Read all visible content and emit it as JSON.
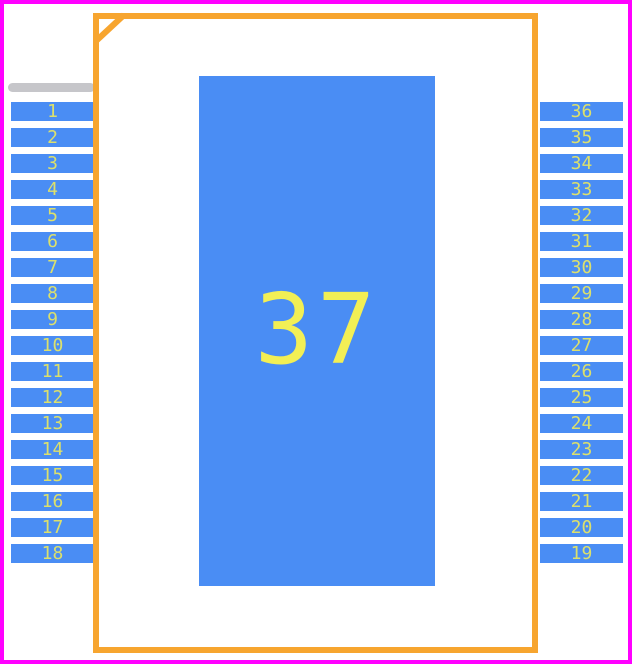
{
  "colors": {
    "background": "#ffffff",
    "pad_blue": "#4a8df4",
    "outline_orange": "#f7a52f",
    "border_magenta": "#ff00ff",
    "marker_gray": "#c6c6ca",
    "pin_number_yellow": "#dce06c",
    "pad_number_yellow": "#f2ef55"
  },
  "footprint": {
    "center_pad": {
      "number": "37"
    },
    "left_pins": {
      "numbers": [
        "1",
        "2",
        "3",
        "4",
        "5",
        "6",
        "7",
        "8",
        "9",
        "10",
        "11",
        "12",
        "13",
        "14",
        "15",
        "16",
        "17",
        "18"
      ]
    },
    "right_pins": {
      "numbers": [
        "36",
        "35",
        "34",
        "33",
        "32",
        "31",
        "30",
        "29",
        "28",
        "27",
        "26",
        "25",
        "24",
        "23",
        "22",
        "21",
        "20",
        "19"
      ]
    }
  }
}
